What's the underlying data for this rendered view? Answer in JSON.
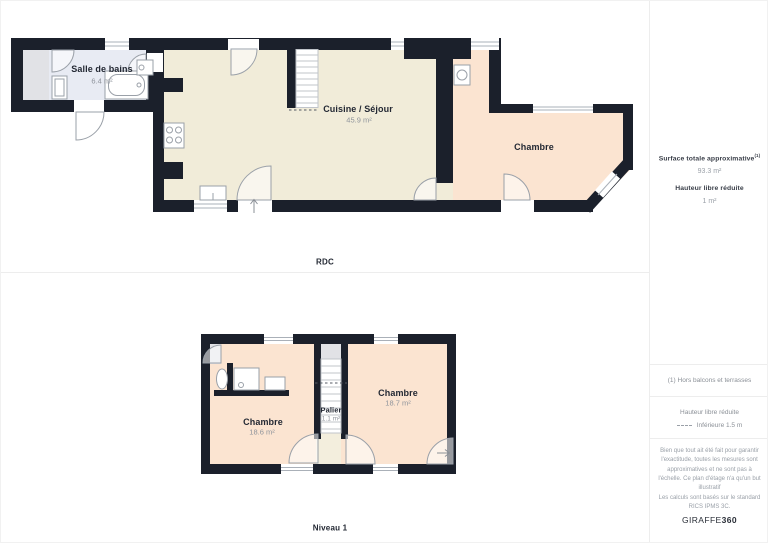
{
  "colors": {
    "wall": "#1b202b",
    "floor_kitchen": "#f1ecd9",
    "floor_bedroom": "#fbe4d1",
    "floor_bathroom": "#e8ebf3",
    "floor_grey": "#e1e2e6",
    "label_dark": "#232833",
    "label_grey": "#8e939b",
    "divider": "#ededed"
  },
  "floors": {
    "rdc": {
      "name": "RDC",
      "rooms": [
        {
          "name": "Salle de bains",
          "area": "6.4 m²"
        },
        {
          "name": "Cuisine / Séjour",
          "area": "45.9 m²"
        },
        {
          "name": "Chambre",
          "area": ""
        }
      ]
    },
    "niveau1": {
      "name": "Niveau 1",
      "rooms": [
        {
          "name": "Chambre",
          "area": "18.6 m²"
        },
        {
          "name": "Palier",
          "area": "1.1 m²"
        },
        {
          "name": "Chambre",
          "area": "18.7 m²"
        }
      ]
    }
  },
  "sidebar": {
    "surface_title": "Surface totale approximative",
    "surface_note_ref": "(1)",
    "surface_value": "93.3 m²",
    "height_title": "Hauteur libre réduite",
    "height_value": "1 m²",
    "footnote": "(1) Hors balcons et terrasses",
    "legend_title": "Hauteur libre réduite",
    "legend_item": "Inférieure 1.5 m",
    "disclaimer": "Bien que tout ait été fait pour garantir l'exactitude, toutes les mesures sont approximatives et ne sont pas à l'échelle. Ce plan d'étage n'a qu'un but illustratif",
    "standard": "Les calculs sont basés sur le standard RICS IPMS 3C.",
    "brand_first": "GIRAFFE",
    "brand_last": "360"
  }
}
